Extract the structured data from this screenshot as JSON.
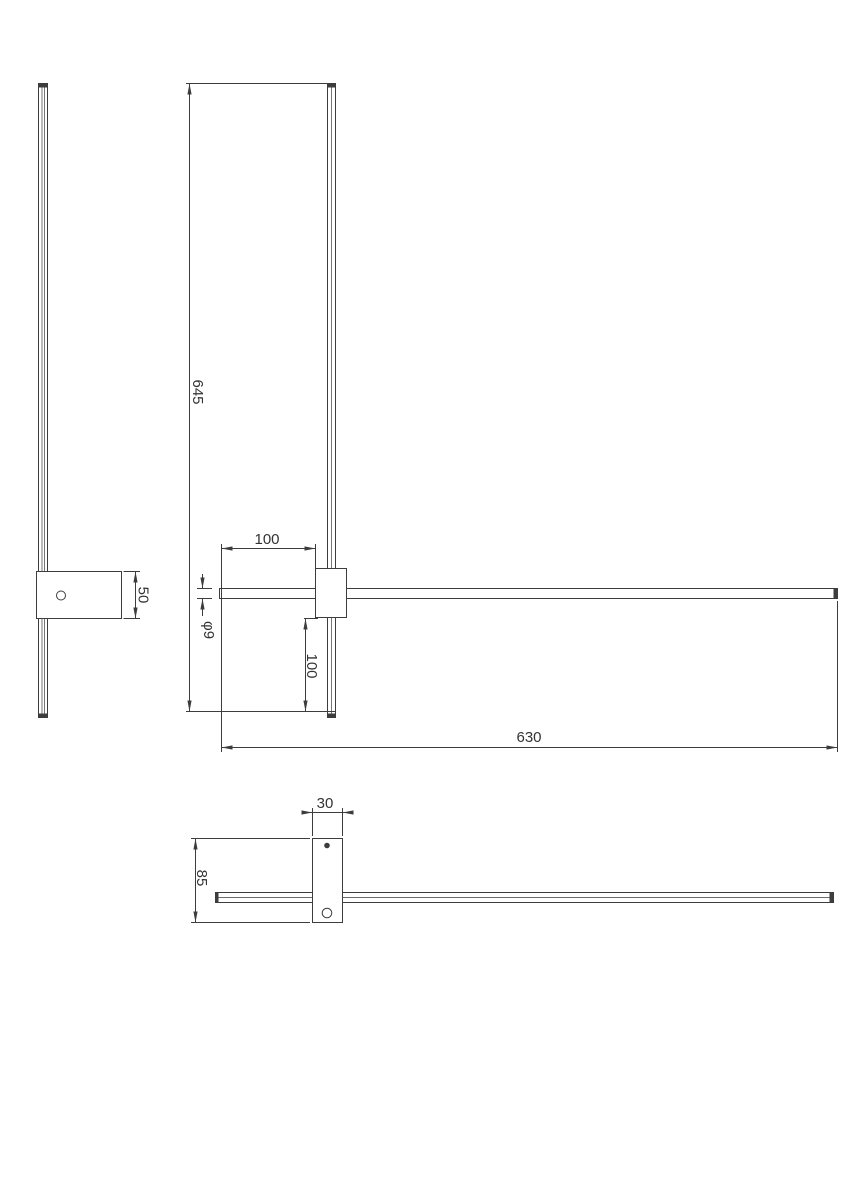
{
  "colors": {
    "background": "#ffffff",
    "line-color": "#3d3d3d",
    "text-color": "#333333"
  },
  "dimensions": {
    "front_view": {
      "total_height": "645",
      "left_offset": "100",
      "tube_diameter": "φ9",
      "bottom_offset": "100",
      "total_width": "630"
    },
    "side_view": {
      "bracket_height": "50"
    },
    "bottom_view": {
      "bracket_width": "30",
      "bracket_depth": "85"
    }
  }
}
